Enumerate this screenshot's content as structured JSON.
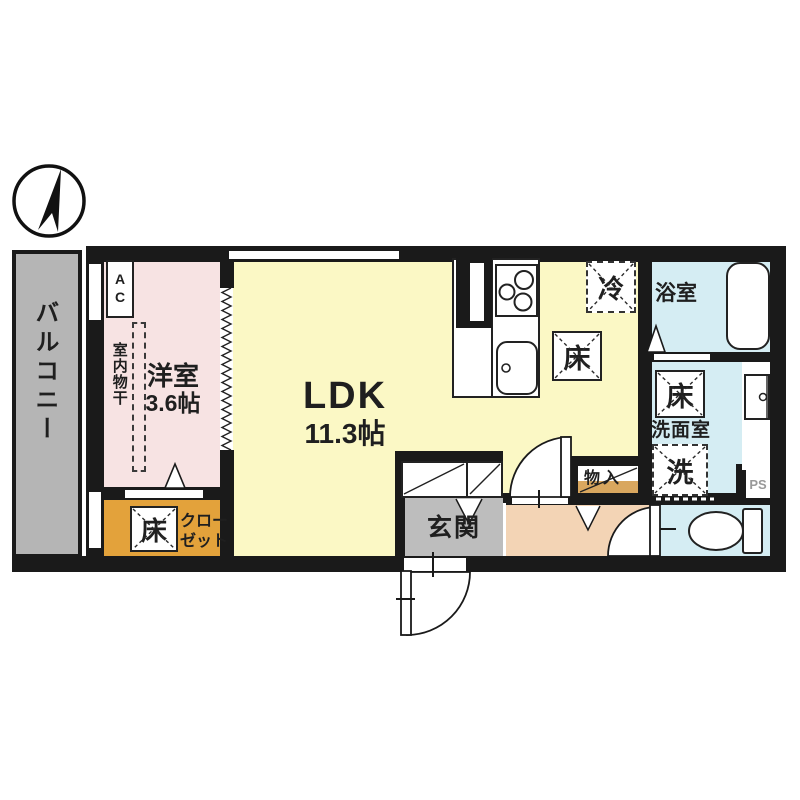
{
  "plan": {
    "type": "apartment-floor-plan",
    "labels": {
      "balcony": "バルコニー",
      "ac_unit": "AC",
      "indoor_drying": "室内物干",
      "western_room_name": "洋室",
      "western_room_size": "3.6帖",
      "ldk_name": "LDK",
      "ldk_size": "11.3帖",
      "refrigerator": "冷",
      "floor_storage": "床",
      "bathroom": "浴室",
      "washroom": "洗面室",
      "washer": "洗",
      "pipe_space": "PS",
      "storage": "物入",
      "closet_line1": "クロー",
      "closet_line2": "ゼット",
      "entrance": "玄関"
    },
    "colors": {
      "wall": "#1a1a1a",
      "western_room": "#f7e3e3",
      "ldk": "#fbf8c5",
      "closet": "#e3a23b",
      "hallway": "#f3d4b5",
      "entrance": "#bdbdbd",
      "wet_area": "#d5edf3",
      "balcony": "#b5b5b5",
      "shelf": "#d9a75f",
      "ps_text": "#999999"
    }
  }
}
